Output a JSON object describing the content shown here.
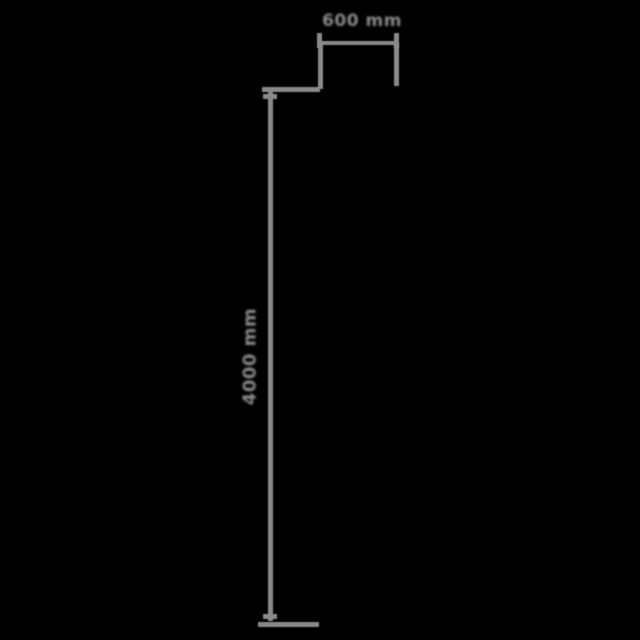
{
  "page": {
    "background_color": "#000000",
    "line_color": "#8a8a8a",
    "label_color": "#8a8a8a"
  },
  "diagram": {
    "type": "product-dimension-drawing",
    "width_dimension": {
      "label": "600 mm",
      "orientation": "horizontal",
      "position": "top"
    },
    "height_dimension": {
      "label": "4000 mm",
      "orientation": "vertical",
      "position": "left"
    }
  }
}
